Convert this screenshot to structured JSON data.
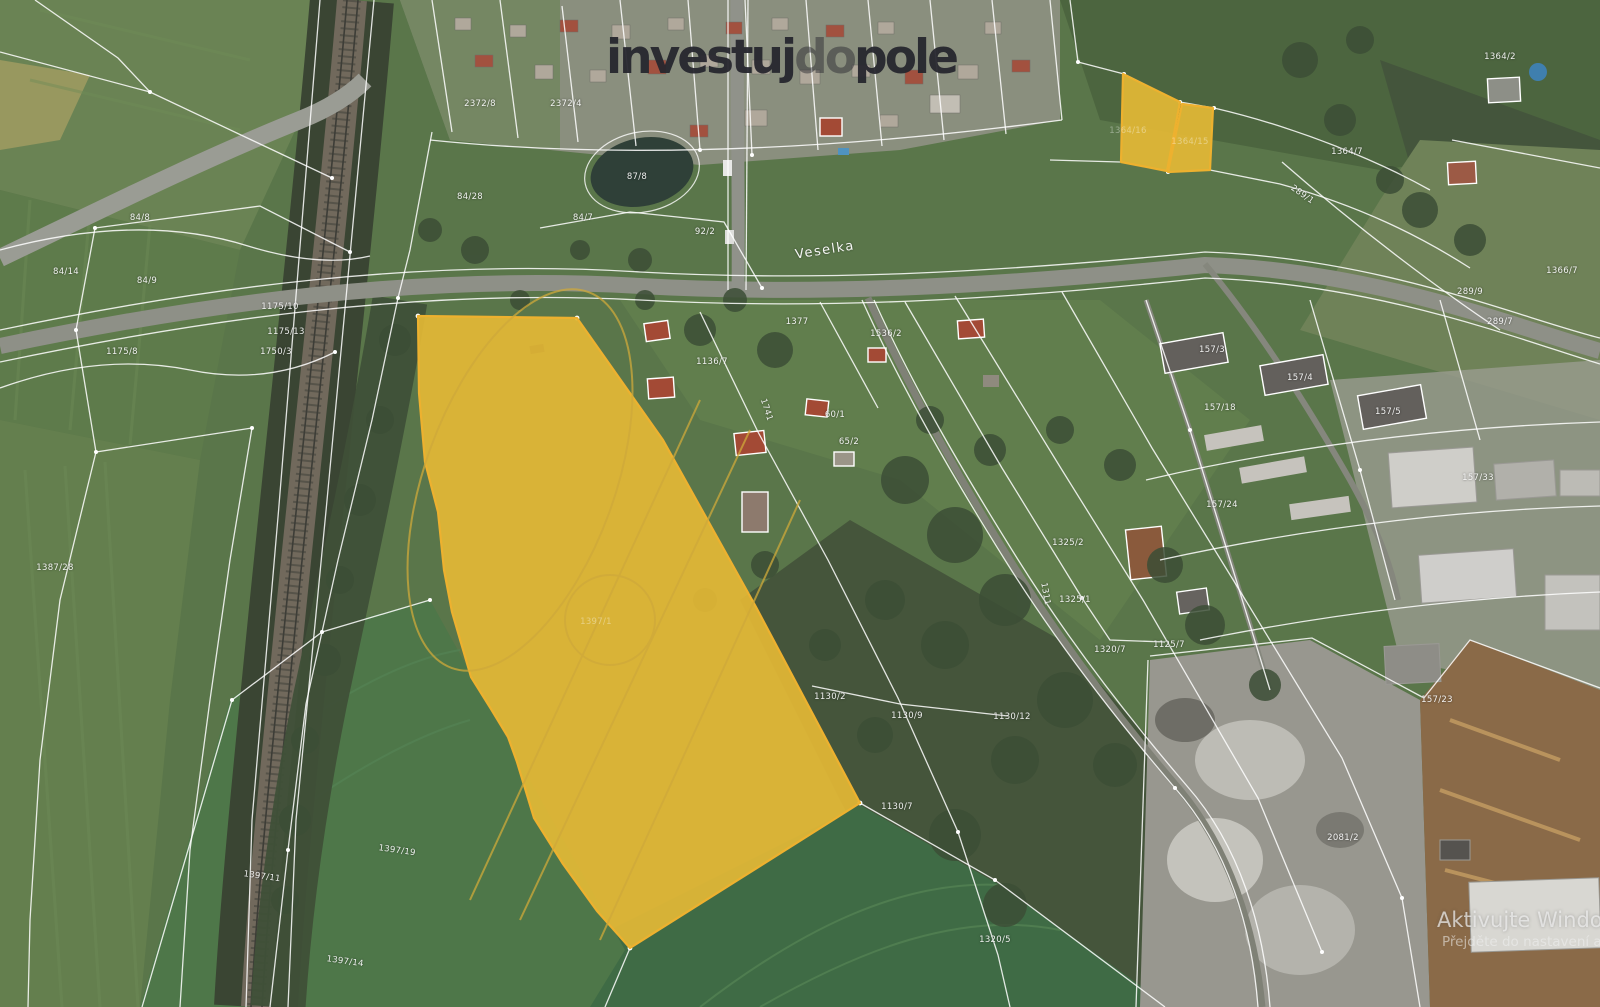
{
  "logo": {
    "part1": "investuj",
    "part2": "do",
    "part3": "pole"
  },
  "watermark": {
    "line1": "Aktivujte Windows",
    "line2": "Přejděte do nastavení a"
  },
  "map": {
    "street_label": "Veselka",
    "highlight": {
      "fill": "rgba(231,186,53,0.9)",
      "stroke": "#edb12f"
    },
    "highlighted_parcel_labels": [
      "1397/1",
      "1364/16",
      "1364/15"
    ],
    "parcel_labels": [
      {
        "x": 140,
        "y": 218,
        "t": "84/8"
      },
      {
        "x": 147,
        "y": 281,
        "t": "84/9"
      },
      {
        "x": 66,
        "y": 272,
        "t": "84/14"
      },
      {
        "x": 280,
        "y": 307,
        "t": "1175/10"
      },
      {
        "x": 286,
        "y": 332,
        "t": "1175/13"
      },
      {
        "x": 276,
        "y": 352,
        "t": "1750/3"
      },
      {
        "x": 122,
        "y": 352,
        "t": "1175/8"
      },
      {
        "x": 55,
        "y": 568,
        "t": "1387/28"
      },
      {
        "x": 262,
        "y": 877,
        "t": "1397/11",
        "rot": 8
      },
      {
        "x": 397,
        "y": 851,
        "t": "1397/19",
        "rot": 8
      },
      {
        "x": 345,
        "y": 962,
        "t": "1397/14",
        "rot": 8
      },
      {
        "x": 480,
        "y": 104,
        "t": "2372/8"
      },
      {
        "x": 566,
        "y": 104,
        "t": "2372/4"
      },
      {
        "x": 470,
        "y": 197,
        "t": "84/28"
      },
      {
        "x": 637,
        "y": 177,
        "t": "87/8"
      },
      {
        "x": 583,
        "y": 218,
        "t": "84/7"
      },
      {
        "x": 705,
        "y": 232,
        "t": "92/2"
      },
      {
        "x": 797,
        "y": 322,
        "t": "1377"
      },
      {
        "x": 886,
        "y": 334,
        "t": "1536/2"
      },
      {
        "x": 712,
        "y": 362,
        "t": "1136/7"
      },
      {
        "x": 766,
        "y": 410,
        "t": "1741",
        "rot": 72
      },
      {
        "x": 835,
        "y": 415,
        "t": "60/1"
      },
      {
        "x": 849,
        "y": 442,
        "t": "65/2"
      },
      {
        "x": 596,
        "y": 622,
        "t": "1397/1",
        "faint": true
      },
      {
        "x": 1128,
        "y": 131,
        "t": "1364/16",
        "faint": true
      },
      {
        "x": 1190,
        "y": 142,
        "t": "1364/15",
        "faint": true
      },
      {
        "x": 830,
        "y": 697,
        "t": "1130/2"
      },
      {
        "x": 907,
        "y": 716,
        "t": "1130/9"
      },
      {
        "x": 1012,
        "y": 717,
        "t": "1130/12"
      },
      {
        "x": 897,
        "y": 807,
        "t": "1130/7"
      },
      {
        "x": 1169,
        "y": 645,
        "t": "1125/7"
      },
      {
        "x": 1068,
        "y": 543,
        "t": "1325/2"
      },
      {
        "x": 1075,
        "y": 600,
        "t": "1325/1"
      },
      {
        "x": 1045,
        "y": 594,
        "t": "1311",
        "rot": 80
      },
      {
        "x": 1110,
        "y": 650,
        "t": "1320/7"
      },
      {
        "x": 1212,
        "y": 350,
        "t": "157/3"
      },
      {
        "x": 1300,
        "y": 378,
        "t": "157/4"
      },
      {
        "x": 1388,
        "y": 412,
        "t": "157/5"
      },
      {
        "x": 1220,
        "y": 408,
        "t": "157/18"
      },
      {
        "x": 1222,
        "y": 505,
        "t": "157/24"
      },
      {
        "x": 1478,
        "y": 478,
        "t": "157/33"
      },
      {
        "x": 1437,
        "y": 700,
        "t": "157/23"
      },
      {
        "x": 1347,
        "y": 152,
        "t": "1364/7"
      },
      {
        "x": 1302,
        "y": 195,
        "t": "289/1",
        "rot": 35
      },
      {
        "x": 1562,
        "y": 271,
        "t": "1366/7"
      },
      {
        "x": 1500,
        "y": 322,
        "t": "289/7"
      },
      {
        "x": 1470,
        "y": 292,
        "t": "289/9"
      },
      {
        "x": 1343,
        "y": 838,
        "t": "2081/2"
      },
      {
        "x": 995,
        "y": 940,
        "t": "1320/5"
      },
      {
        "x": 1500,
        "y": 57,
        "t": "1364/2"
      }
    ]
  }
}
